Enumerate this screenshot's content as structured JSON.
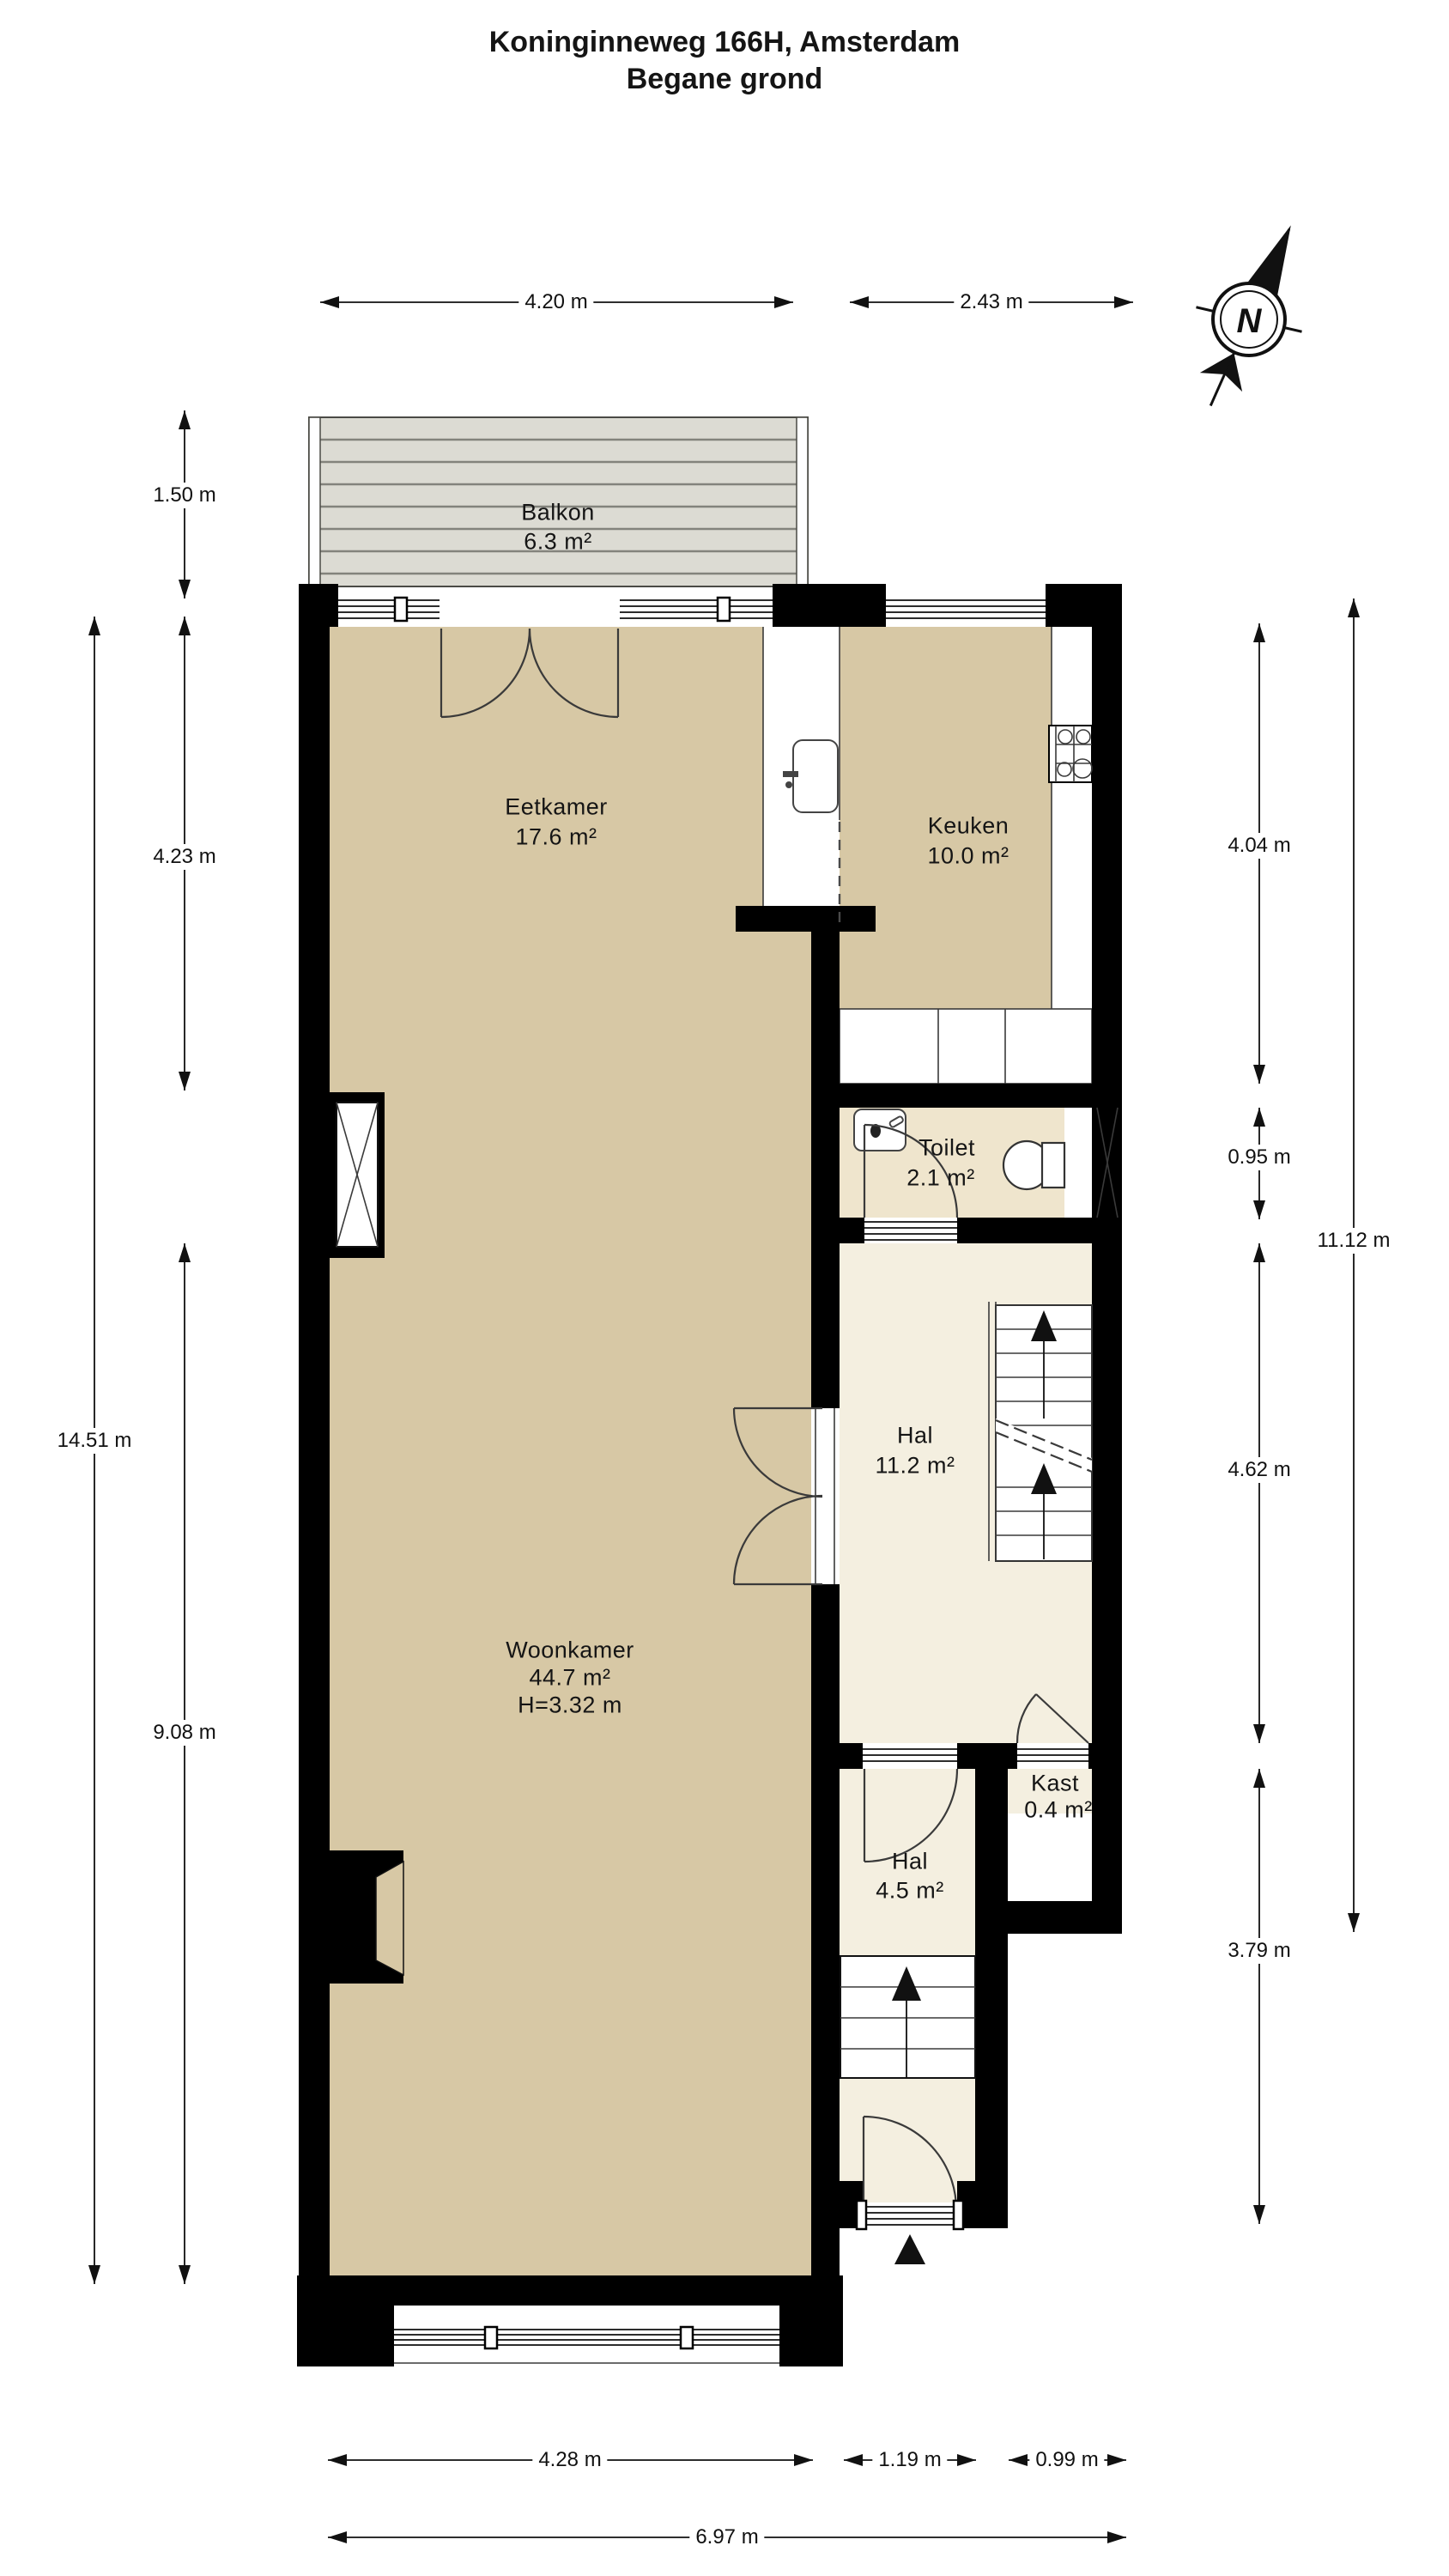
{
  "title": {
    "line1": "Koninginneweg 166H, Amsterdam",
    "line2": "Begane grond"
  },
  "compass": {
    "north_label": "N"
  },
  "rooms": {
    "balkon": {
      "name": "Balkon",
      "area": "6.3 m²"
    },
    "eetkamer": {
      "name": "Eetkamer",
      "area": "17.6 m²"
    },
    "keuken": {
      "name": "Keuken",
      "area": "10.0 m²"
    },
    "toilet": {
      "name": "Toilet",
      "area": "2.1 m²"
    },
    "hal": {
      "name": "Hal",
      "area": "11.2 m²"
    },
    "woonkamer": {
      "name": "Woonkamer",
      "area": "44.7 m²",
      "ceiling_height": "H=3.32 m"
    },
    "kast": {
      "name": "Kast",
      "area": "0.4 m²"
    },
    "hal_entree": {
      "name": "Hal",
      "area": "4.5 m²"
    }
  },
  "dimensions": {
    "top": [
      {
        "label": "4.20 m"
      },
      {
        "label": "2.43 m"
      }
    ],
    "bottom": [
      {
        "label": "4.28 m"
      },
      {
        "label": "1.19 m"
      },
      {
        "label": "0.99 m"
      },
      {
        "label": "6.97 m"
      }
    ],
    "left": [
      {
        "label": "1.50 m"
      },
      {
        "label": "4.23 m"
      },
      {
        "label": "14.51 m"
      },
      {
        "label": "9.08 m"
      }
    ],
    "right": [
      {
        "label": "4.04 m"
      },
      {
        "label": "0.95 m"
      },
      {
        "label": "11.12 m"
      },
      {
        "label": "4.62 m"
      },
      {
        "label": "3.79 m"
      }
    ]
  },
  "colors": {
    "wall": "#000000",
    "room": "#d7c8a5",
    "hall": "#f4efe0",
    "toilet": "#efe5cd",
    "deck": "#dcdbd3",
    "deckline": "#83837c",
    "line": "#3a3a3a",
    "ink": "#151515"
  }
}
